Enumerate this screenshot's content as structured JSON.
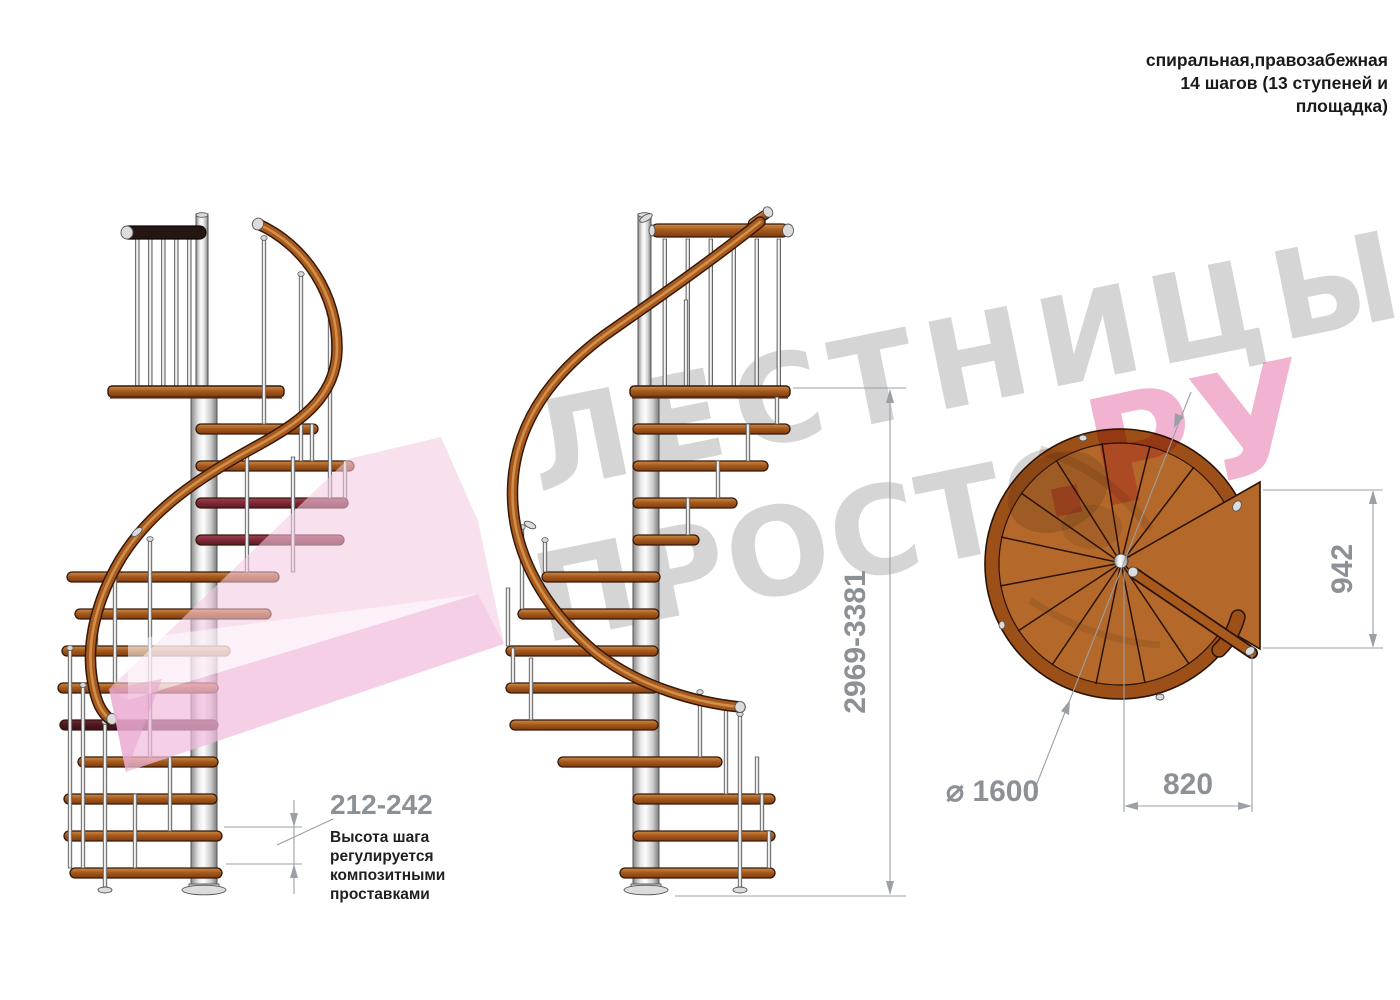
{
  "title": {
    "line1": "спиральная,правозабежная",
    "line2": "14 шагов (13 ступеней и",
    "line3": "площадка)"
  },
  "watermark": {
    "word1": "ЛЕСТНИЦЫ",
    "word2": "ПРОСТО",
    "word2_suffix": ".РУ"
  },
  "dimensions": {
    "step_height": "212-242",
    "total_height": "2969-3381",
    "landing_width": "942",
    "landing_depth": "820",
    "diameter": "⌀ 1600"
  },
  "note": {
    "line1": "Высота шага",
    "line2": "регулируется",
    "line3": "композитными",
    "line4": "проставками"
  },
  "colors": {
    "wood_mid": "#a85a1d",
    "wood_dark": "#35180a",
    "wood_light": "#d79a55",
    "plan_wood": "#b4692b",
    "plan_rim": "#9d4f18",
    "dim_line": "#9aa0a5",
    "dim_text": "#8b9196",
    "ink": "#1f1f1f",
    "wm_gray": "#d5d5d5",
    "wm_pink": "#f2b3d0",
    "ribbon1": "#f5cae4",
    "ribbon2": "#eeaed6",
    "ribbon3": "#e79fce"
  }
}
